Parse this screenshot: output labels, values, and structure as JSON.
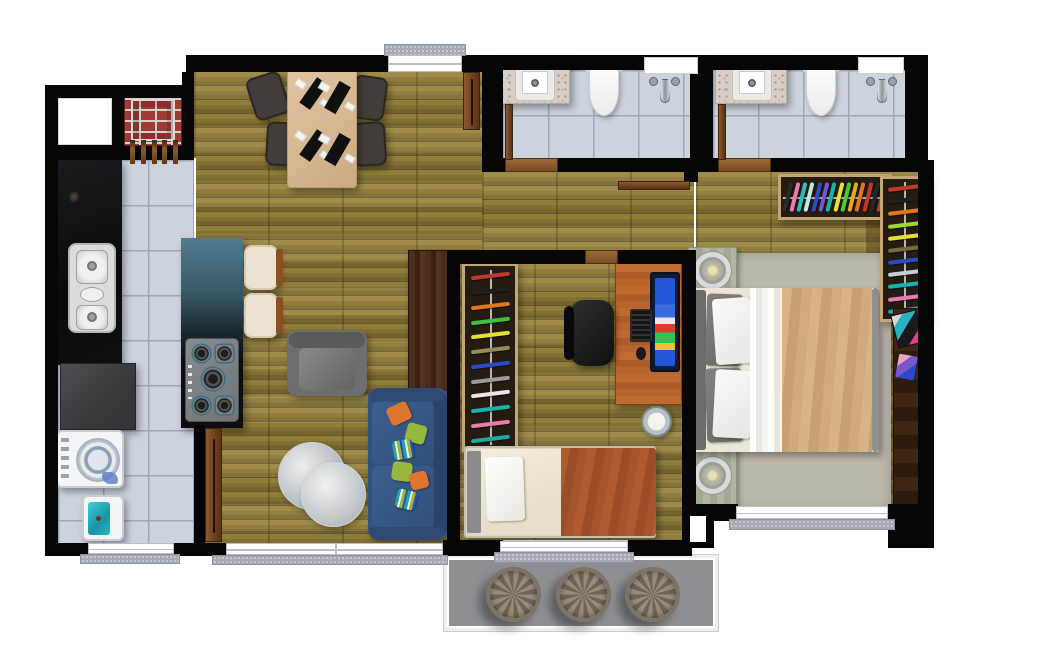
{
  "meta": {
    "title": "Two-bedroom apartment floor plan, top-down 3D render",
    "style": "furnished architectural plan on white background"
  },
  "palette": {
    "wall": "#060606",
    "wood_floor": "#8e7b38",
    "tile_floor": "#ccd3dd",
    "balcony_floor": "#8d8f94",
    "black_marble": "#0c0c10",
    "island_granite_top": "#507a8d",
    "dining_table": "#dcc09c",
    "dark_chair": "#433d3a",
    "sofa_navy": "#33517d",
    "armchair_gray": "#6b6b6b",
    "pillow_orange": "#e0762c",
    "pillow_green": "#95b83d",
    "bed1_blanket_rust": "#a7532e",
    "bed2_blanket_tan": "#d2a97c",
    "rug_gray": "#bdb8ac",
    "nightstand_sage": "#a9b29c",
    "desk_wood": "#b5652f",
    "door_wood": "#7a4c26",
    "grill_brick": "#a03a34",
    "laundry_water": "#27b3c0",
    "window_sill": "#a6abb3"
  },
  "rooms": {
    "kitchen": {
      "label": "Kitchen"
    },
    "service": {
      "label": "Laundry / service area"
    },
    "dining": {
      "label": "Dining room"
    },
    "living": {
      "label": "Living room"
    },
    "hallway": {
      "label": "Hallway"
    },
    "bathroom1": {
      "label": "Bathroom 1"
    },
    "bathroom2": {
      "label": "Bathroom 2 (en-suite)"
    },
    "bedroom1": {
      "label": "Bedroom 1 (single bed + desk)"
    },
    "bedroom2": {
      "label": "Bedroom 2 (double bed)"
    },
    "balcony": {
      "label": "Technical balcony"
    }
  },
  "furniture": {
    "kitchen": [
      "brick barbecue grill with tools",
      "black marble counter",
      "stainless double sink",
      "island with 5-burner cooktop",
      "2 bar stools",
      "refrigerator"
    ],
    "service": [
      "top-load washing machine",
      "laundry tank with water"
    ],
    "dining": [
      "wood table for four",
      "4 dark chairs",
      "4 place settings"
    ],
    "living": [
      "dark wood TV panel",
      "gray armchair",
      "navy sofa with 6 throw pillows",
      "2 round silver side tables"
    ],
    "bathroom1": [
      "granite vanity with sink",
      "toilet",
      "shower with niche"
    ],
    "bathroom2": [
      "granite vanity with sink",
      "toilet",
      "shower with niche"
    ],
    "bedroom1": [
      "open wardrobe with clothes",
      "wood desk",
      "computer monitor",
      "keyboard and mouse",
      "office chair",
      "waste bin",
      "single bed with rust blanket"
    ],
    "bedroom2": [
      "double bed with tan blanket",
      "2 sage nightstands with ring lamps",
      "L-shaped open wardrobe with clothes",
      "dark side shelf with magazines and phone",
      "gray rug"
    ],
    "balcony": [
      "3 round planters"
    ]
  },
  "counts": {
    "bedrooms": 2,
    "bathrooms": 2,
    "balcony_planters": 3,
    "dining_seats": 4
  },
  "wardrobe_clothes": {
    "bedroom1": [
      "#c0392b",
      "#1f1f1f",
      "#e0761f",
      "#3fbf3f",
      "#e5e032",
      "#8f8f56",
      "#2b49c9",
      "#9a9a9a",
      "#e8e8e8",
      "#18b2ae",
      "#e87cb1",
      "#1fa8a0"
    ],
    "bedroom2_top": [
      "#2a2a2a",
      "#e87cb1",
      "#25c0bd",
      "#bfe8e6",
      "#2b49c9",
      "#7a55cc",
      "#18b2ae",
      "#e5e032",
      "#4fc838",
      "#e8a826",
      "#e0761f",
      "#c0392b",
      "#262626",
      "#c04040"
    ],
    "bedroom2_side": [
      "#c0392b",
      "#1f1f1f",
      "#e0761f",
      "#9fd832",
      "#e5e032",
      "#6f6f45",
      "#2b49c9",
      "#c9ced3",
      "#18b2ae",
      "#e87cb1",
      "#1fa8a0"
    ]
  },
  "monitor_screen_colors": [
    "#2355d8",
    "#e8e8e8",
    "#d8402a",
    "#35c055",
    "#f0c22a"
  ]
}
